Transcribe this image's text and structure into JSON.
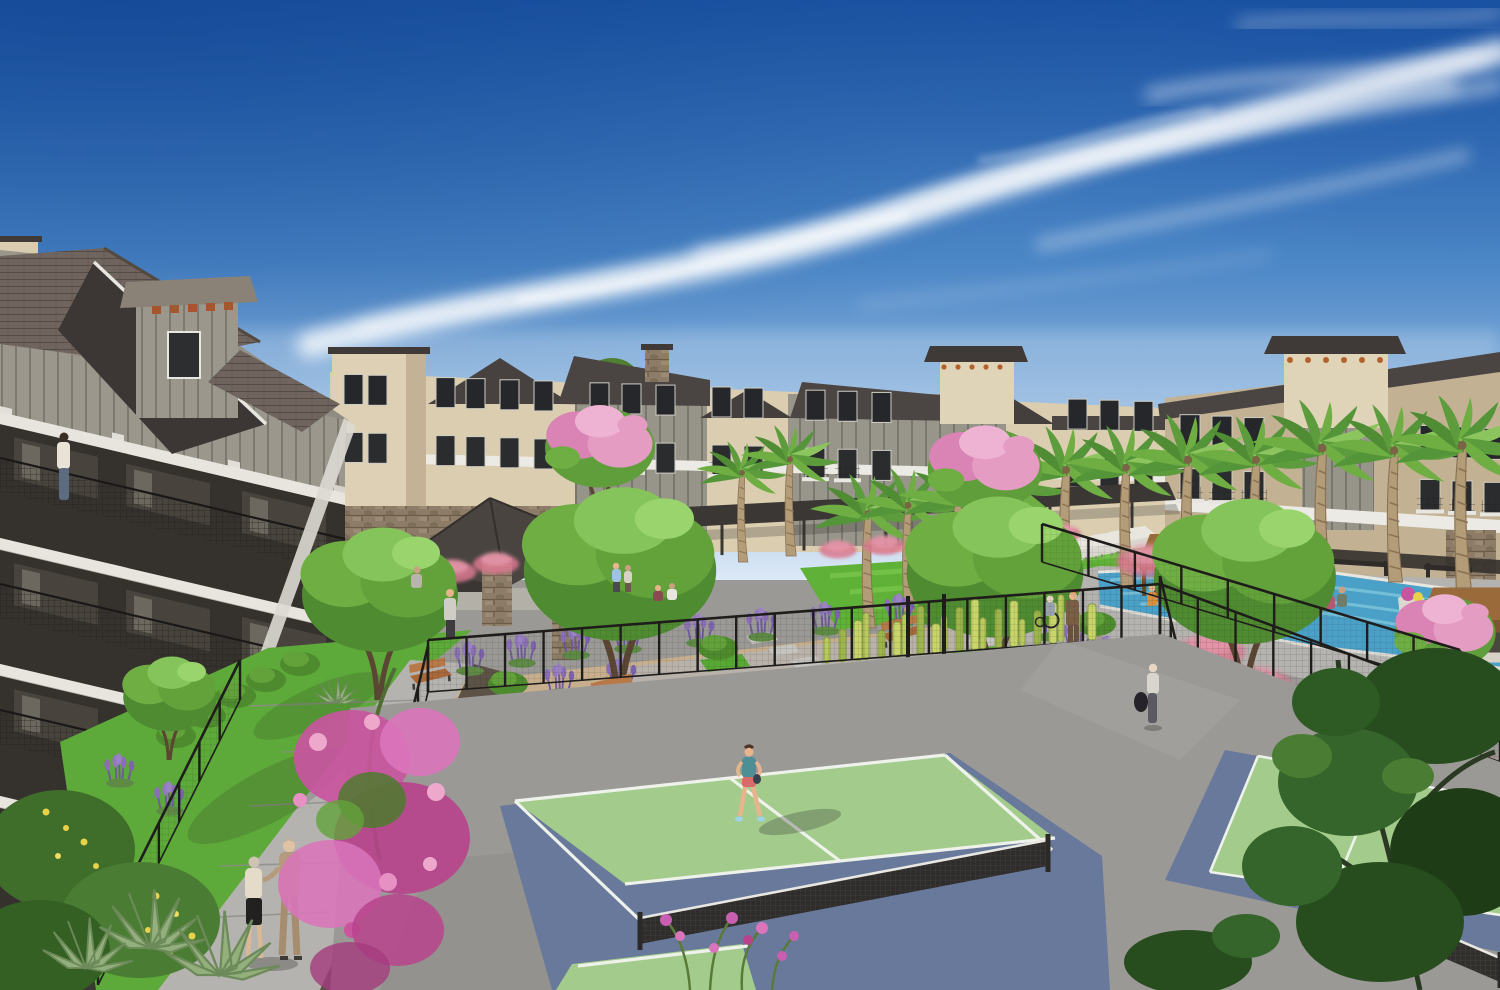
{
  "meta": {
    "type": "architectural-rendering",
    "description": "Aerial courtyard view of a three-story apartment community with two pickleball courts, a resort pool with cabanas, palm trees and desert landscaping under a blue sky with wispy cirrus clouds",
    "time_of_day": "midday, sunny"
  },
  "palette": {
    "sky_top": "#1d55a4",
    "sky_mid": "#4b86c6",
    "sky_low": "#9cc0e4",
    "sky_horizon": "#dce9f6",
    "cloud": "#ffffff",
    "roof_dark": "#45403d",
    "roof_shingle": "#6f645e",
    "stucco_cream": "#dbcdb0",
    "stucco_cream_shade": "#c2b193",
    "stucco_sage": "#97948a",
    "trim_white": "#eceae4",
    "window_dark": "#25272a",
    "stone": "#8d7c67",
    "corbel_orange": "#b4622d",
    "palm_frond": "#5d9c3c",
    "palm_frond_light": "#8cc45e",
    "palm_trunk": "#b39c78",
    "tree_green": "#4f8c31",
    "tree_green_light": "#85c45a",
    "lawn": "#5fb237",
    "pool_water": "#4aa0c6",
    "pool_light": "#86cade",
    "cabana_brown": "#9a6a3b",
    "court_green": "#a3cc8c",
    "court_blue": "#68799c",
    "court_line": "#eef2ea",
    "apron_gray": "#9b9995",
    "path_light": "#b5b3af",
    "granite_tan": "#c7af8d",
    "fence_black": "#1f1d1b",
    "muhly_pink": "#d9788f",
    "bougainvillea": "#c9559f",
    "lavender": "#8468b4",
    "flower_yellow": "#e8d24a",
    "bench_wood": "#a9683a",
    "planter_white": "#ddd8cf"
  },
  "scene": {
    "sky": {
      "condition": "clear blue sky",
      "clouds": "wispy cirrus streaks sweeping up to the right"
    },
    "buildings": {
      "style": "modern farmhouse apartment buildings",
      "stories": "3-4",
      "finishes": "cream stucco and sage board-and-batten with white trim bands",
      "features": [
        "gabled and shed rooflines",
        "private balconies with black metal railings",
        "stone veneer accents",
        "corbel-capped towers",
        "stone chimney",
        "covered ground-floor walkway"
      ]
    },
    "amenities": [
      "two pickleball courts with nets",
      "resort-style lap pool",
      "poolside cabanas",
      "chaise lounges",
      "outdoor kitchen ramada with grill",
      "event lawn",
      "garden benches",
      "curved walking paths",
      "spa water feature with rocks"
    ],
    "vegetation": {
      "species": [
        "fan palms",
        "shade trees",
        "pink flowering oleander",
        "magenta bougainvillea",
        "lavender",
        "pink muhly grass",
        "columnar cacti",
        "agave",
        "boxwood shrubs",
        "yellow wildflowers"
      ],
      "palms": {
        "count": 13,
        "positions": [
          [
            742,
            562,
            0.72
          ],
          [
            790,
            556,
            0.78
          ],
          [
            868,
            628,
            0.92
          ],
          [
            908,
            612,
            0.86
          ],
          [
            958,
            618,
            0.95
          ],
          [
            1012,
            602,
            0.92
          ],
          [
            1066,
            594,
            1.0
          ],
          [
            1126,
            588,
            0.97
          ],
          [
            1188,
            590,
            1.05
          ],
          [
            1256,
            584,
            1.0
          ],
          [
            1322,
            587,
            1.12
          ],
          [
            1394,
            582,
            1.06
          ],
          [
            1462,
            588,
            1.15
          ]
        ]
      },
      "cacti_row": {
        "count": 21
      }
    },
    "pool_area": {
      "cabanas": 3,
      "loungers": {
        "count": 7,
        "positions": [
          [
            1036,
            560
          ],
          [
            1052,
            556
          ],
          [
            1068,
            552
          ],
          [
            1084,
            549
          ],
          [
            1100,
            546
          ],
          [
            1116,
            543
          ],
          [
            1132,
            540
          ]
        ]
      },
      "planters": 2
    },
    "courts": {
      "count": 2,
      "surface": "sage green play area with slate blue surrounds and white striping",
      "enclosure": "black steel mesh fence"
    },
    "people": [
      {
        "id": "woman-on-balcony",
        "description": "woman standing at a balcony railing of the left building"
      },
      {
        "id": "elderly-couple",
        "description": "elderly couple strolling arm-in-arm on the curved walkway"
      },
      {
        "id": "pickleball-player",
        "description": "woman in teal top and coral shorts in ready position on the near court"
      },
      {
        "id": "woman-with-duffel",
        "description": "woman carrying a dark duffel bag walking toward the far court"
      },
      {
        "id": "man-with-wheelchair-companion",
        "description": "man in a brown suit walking beside a companion using a wheelchair near the pool path"
      },
      {
        "id": "couple-on-lawn",
        "description": "two residents chatting on the event lawn"
      },
      {
        "id": "gardeners-on-lawn",
        "description": "two people crouching together on the lawn"
      },
      {
        "id": "man-at-outdoor-kitchen",
        "description": "man standing beside the outdoor kitchen terrace"
      },
      {
        "id": "cook-at-grill",
        "description": "person at the grill under the ramada"
      },
      {
        "id": "cabana-guest",
        "description": "person relaxing inside a poolside cabana"
      },
      {
        "id": "poolside-pair-left",
        "description": "two people seated near a pool planter"
      },
      {
        "id": "poolside-pair-right",
        "description": "two people seated under the right pergola"
      }
    ]
  }
}
